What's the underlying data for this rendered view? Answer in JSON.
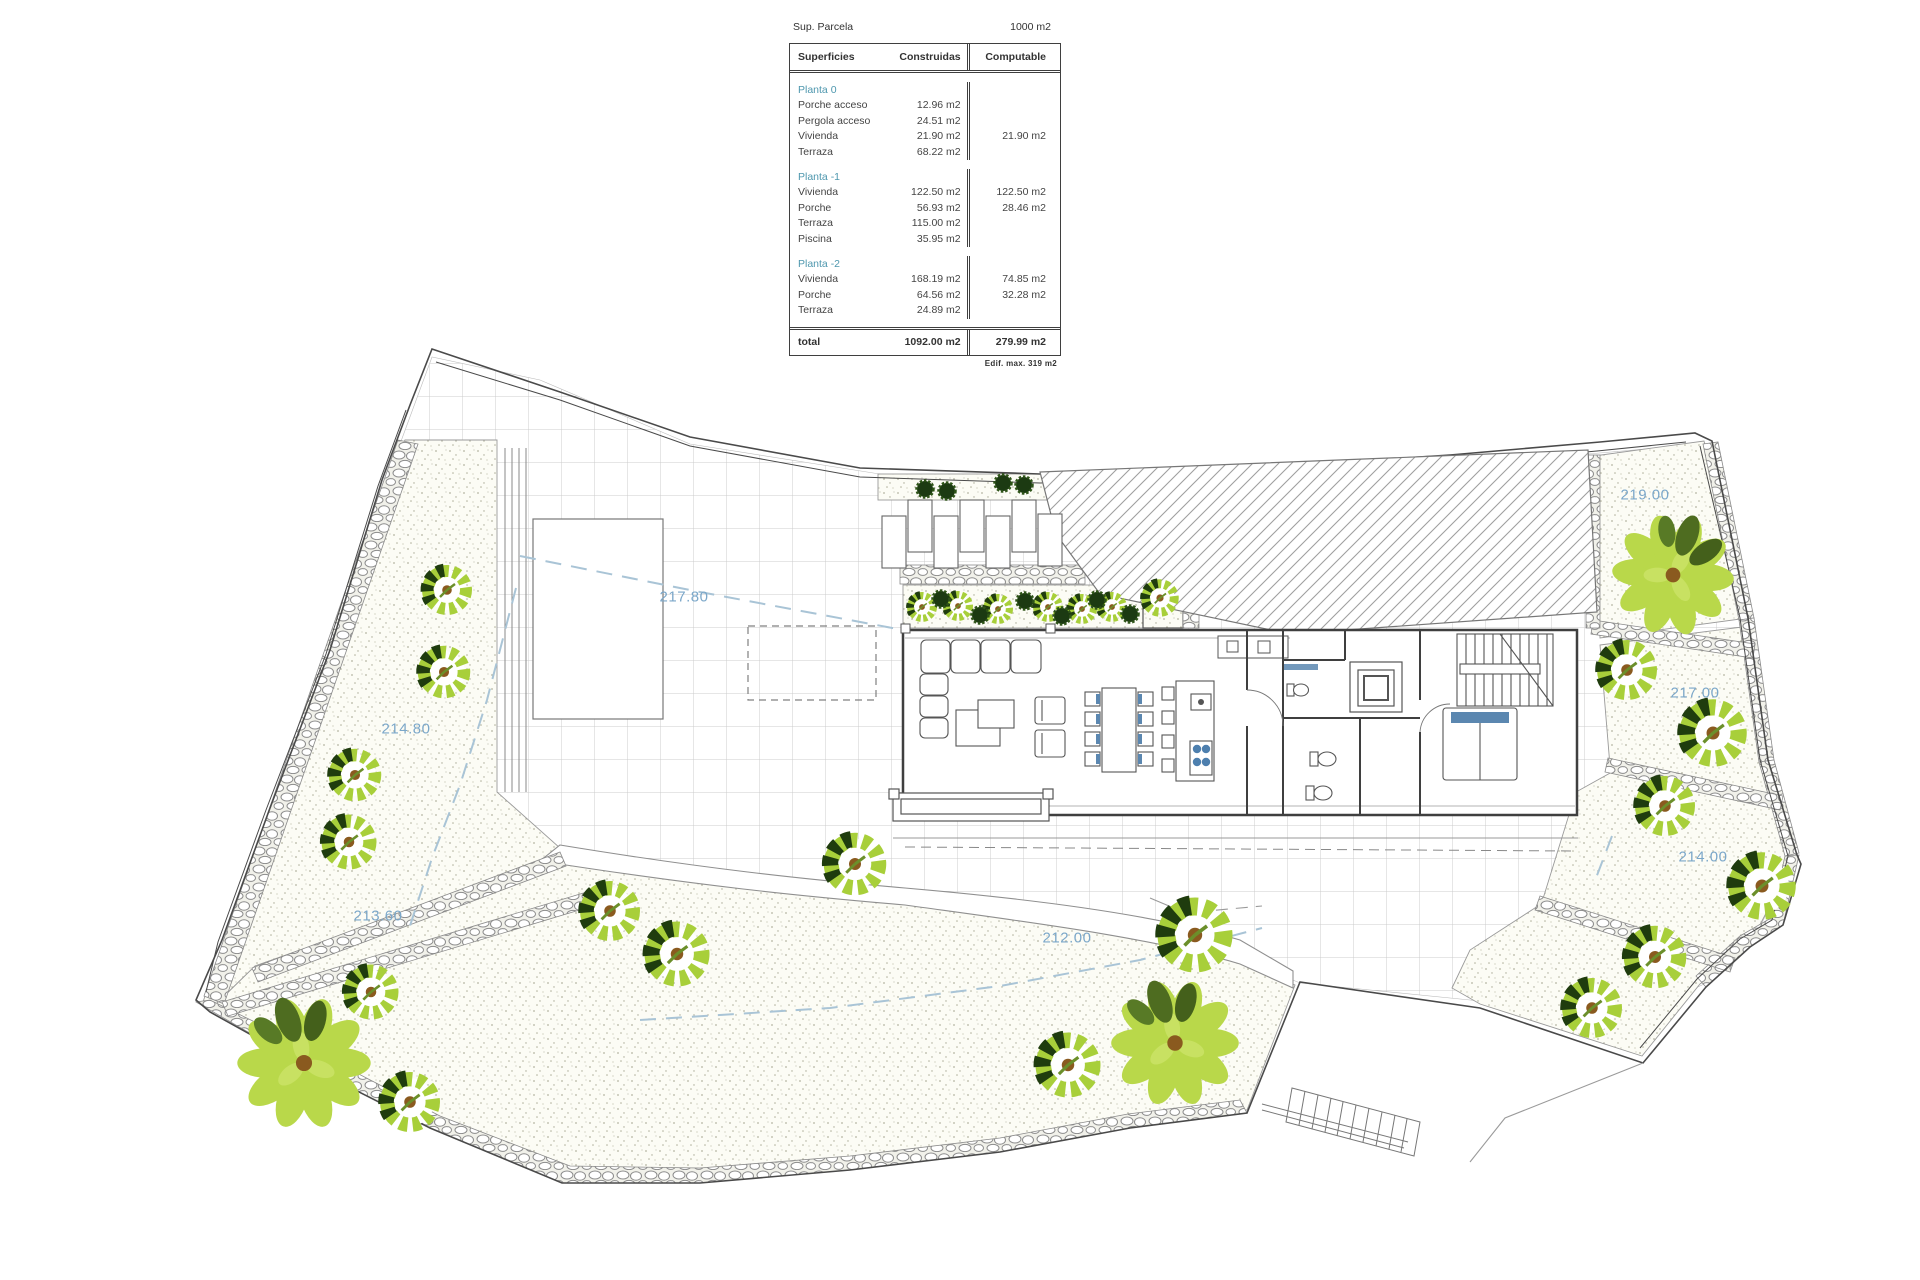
{
  "panel": {
    "sup_label": "Sup. Parcela",
    "sup_value": "1000 m2",
    "headers": {
      "col1": "Superficies",
      "col2": "Construidas",
      "col3": "Computable"
    },
    "sections": [
      {
        "title": "Planta 0",
        "rows": [
          {
            "label": "Porche acceso",
            "built": "12.96 m2",
            "comp": ""
          },
          {
            "label": "Pergola acceso",
            "built": "24.51 m2",
            "comp": ""
          },
          {
            "label": "Vivienda",
            "built": "21.90 m2",
            "comp": "21.90 m2"
          },
          {
            "label": "Terraza",
            "built": "68.22 m2",
            "comp": ""
          }
        ]
      },
      {
        "title": "Planta -1",
        "rows": [
          {
            "label": "Vivienda",
            "built": "122.50 m2",
            "comp": "122.50 m2"
          },
          {
            "label": "Porche",
            "built": "56.93 m2",
            "comp": "28.46 m2"
          },
          {
            "label": "Terraza",
            "built": "115.00 m2",
            "comp": ""
          },
          {
            "label": "Piscina",
            "built": "35.95 m2",
            "comp": ""
          }
        ]
      },
      {
        "title": "Planta -2",
        "rows": [
          {
            "label": "Vivienda",
            "built": "168.19 m2",
            "comp": "74.85 m2"
          },
          {
            "label": "Porche",
            "built": "64.56 m2",
            "comp": "32.28 m2"
          },
          {
            "label": "Terraza",
            "built": "24.89 m2",
            "comp": ""
          }
        ]
      }
    ],
    "total": {
      "label": "total",
      "built": "1092.00 m2",
      "comp": "279.99 m2"
    },
    "note": "Edif. max.  319 m2"
  },
  "plan": {
    "elevation_labels": [
      {
        "text": "219.00",
        "x": 1645,
        "y": 495
      },
      {
        "text": "217.00",
        "x": 1695,
        "y": 693
      },
      {
        "text": "214.00",
        "x": 1703,
        "y": 857
      },
      {
        "text": "214.80",
        "x": 406,
        "y": 729
      },
      {
        "text": "217.80",
        "x": 684,
        "y": 597
      },
      {
        "text": "213.60",
        "x": 378,
        "y": 916
      },
      {
        "text": "212.00",
        "x": 1067,
        "y": 938
      }
    ],
    "accent_colors": {
      "label_blue": "#7ba7c9",
      "contour_blue": "#a9c4d6",
      "water_blue": "#5b87b0",
      "tree_green": "#a8cf3a",
      "tree_dark": "#1f3c0e"
    }
  }
}
